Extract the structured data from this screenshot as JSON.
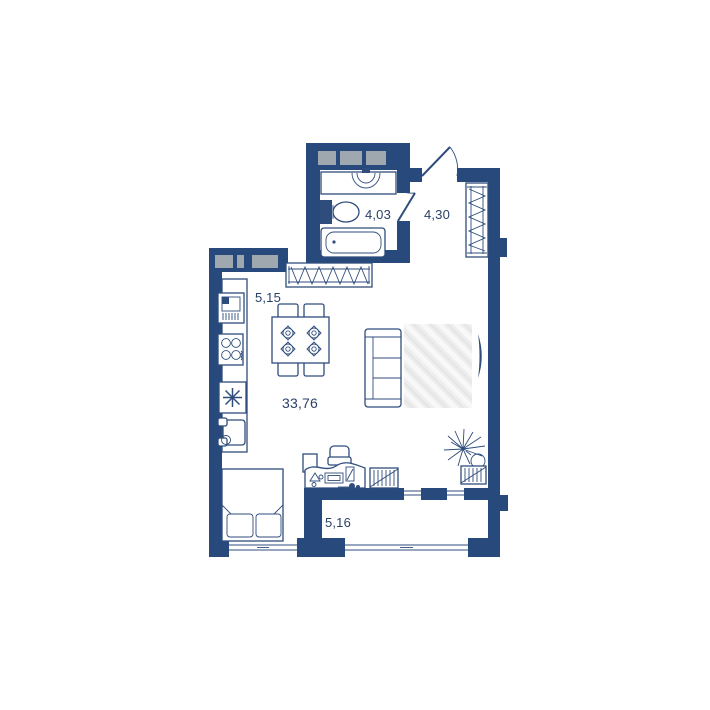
{
  "page": {
    "background": "#ffffff",
    "kind": "apartment floor plan"
  },
  "plan": {
    "colors": {
      "wall": "#27497c",
      "glass": "#9fa7af",
      "line": "#2f4d7c",
      "rug": "#ededed",
      "label": "#2b4168",
      "bg": "#ffffff"
    },
    "rooms": [
      {
        "id": "bathroom",
        "area": "4,03"
      },
      {
        "id": "hallway",
        "area": "4,30"
      },
      {
        "id": "kitchen",
        "area": "5,15"
      },
      {
        "id": "living-room",
        "area": "33,76"
      },
      {
        "id": "balcony",
        "area": "5,16"
      }
    ],
    "furniture": [
      "washbasin",
      "toilet",
      "bathtub",
      "entry-door",
      "bathroom-door",
      "hallway-wardrobe",
      "wall-wardrobe",
      "kitchen-sink",
      "stove",
      "fridge",
      "armchair",
      "dining-table",
      "dining-chairs",
      "sofa",
      "rug",
      "tv",
      "plant",
      "desk",
      "office-chair",
      "radiator",
      "bed",
      "balcony-glazing",
      "windows"
    ]
  }
}
